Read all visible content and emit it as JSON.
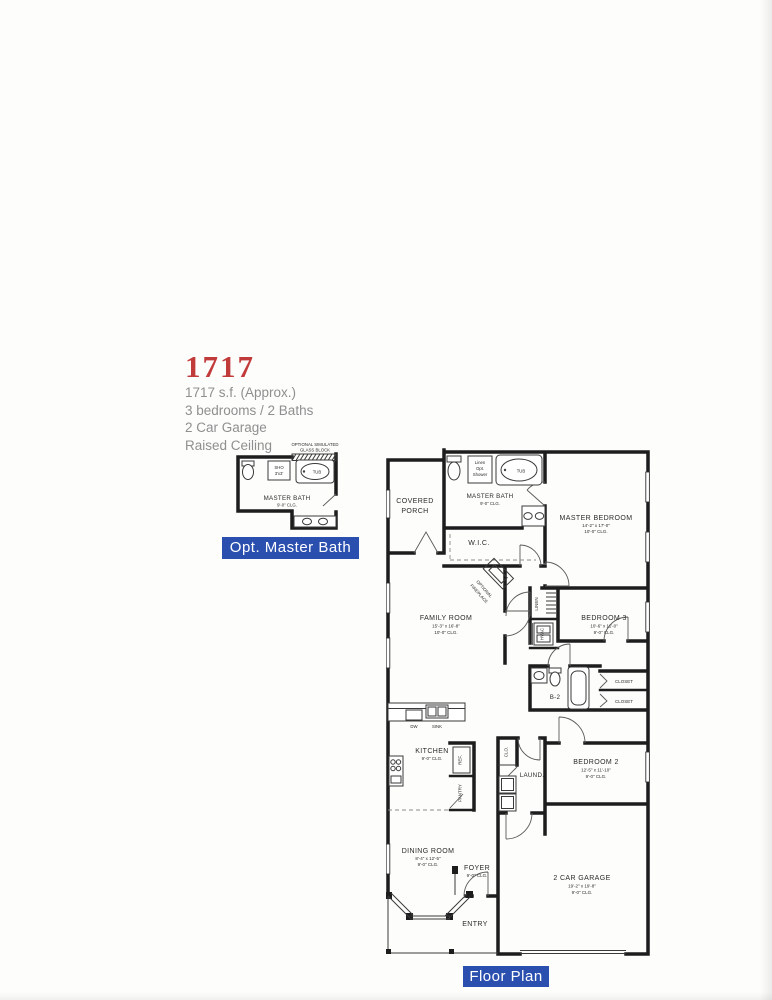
{
  "title_block": {
    "model": "1717",
    "line1": "1717 s.f. (Approx.)",
    "line2": "3 bedrooms / 2 Baths",
    "line3": "2 Car Garage",
    "line4": "Raised Ceiling"
  },
  "inset": {
    "note1": "OPTIONAL SIMULATED",
    "note2": "GLASS BLOCK",
    "sho1": "SHO",
    "sho2": "3'x3'",
    "tub": "TUB",
    "name": "MASTER BATH",
    "clg": "9'-0\" CLG.",
    "banner": "Opt. Master Bath"
  },
  "plan": {
    "porch1": "COVERED",
    "porch2": "PORCH",
    "mbath_name": "MASTER BATH",
    "mbath_clg": "9'-0\" CLG.",
    "shower1": "Linen",
    "shower2": "Opt.",
    "shower3": "Shower",
    "tub": "TUB",
    "mbr_name": "MASTER BEDROOM",
    "mbr_dims": "14'-2\" x 17'-0\"",
    "mbr_clg": "10'-0\" CLG.",
    "wic": "W.I.C.",
    "fp1": "OPTIONAL",
    "fp2": "FIREPLACE",
    "family_name": "FAMILY ROOM",
    "family_dims": "15'-3\" x 16'-8\"",
    "family_clg": "10'-0\" CLG.",
    "linen": "LINEN",
    "hvac": "HVAC",
    "b3_name": "BEDROOM 3",
    "b3_dims": "10'-6\" x 11'-0\"",
    "b3_clg": "9'-0\" CLG.",
    "b2": "B-2",
    "closet1": "CLOSET",
    "closet2": "CLOSET",
    "b2_name": "BEDROOM 2",
    "b2_dims": "12'-5\" x 11'-10\"",
    "b2_clg": "9'-0\" CLG.",
    "dw": "DW",
    "sink": "SINK",
    "kitchen_name": "KITCHEN",
    "kitchen_clg": "9'-0\" CLG.",
    "ref": "REF.",
    "pantry": "PANTRY",
    "clo": "CLO.",
    "laundry": "LAUND.",
    "dining_name": "DINING ROOM",
    "dining_dims": "8'-4\" x 12'-5\"",
    "dining_clg": "9'-0\" CLG.",
    "foyer_name": "FOYER",
    "foyer_clg": "9'-0\" CLG.",
    "entry": "ENTRY",
    "garage_name": "2 CAR GARAGE",
    "garage_dims": "19'-2\" x 19'-8\"",
    "garage_clg": "9'-0\" CLG.",
    "banner": "Floor Plan"
  },
  "colors": {
    "banner_bg": "#2a4fae",
    "accent_red": "#c23b3b",
    "muted_text": "#8f8f8f",
    "wall": "#1d1d1d"
  }
}
